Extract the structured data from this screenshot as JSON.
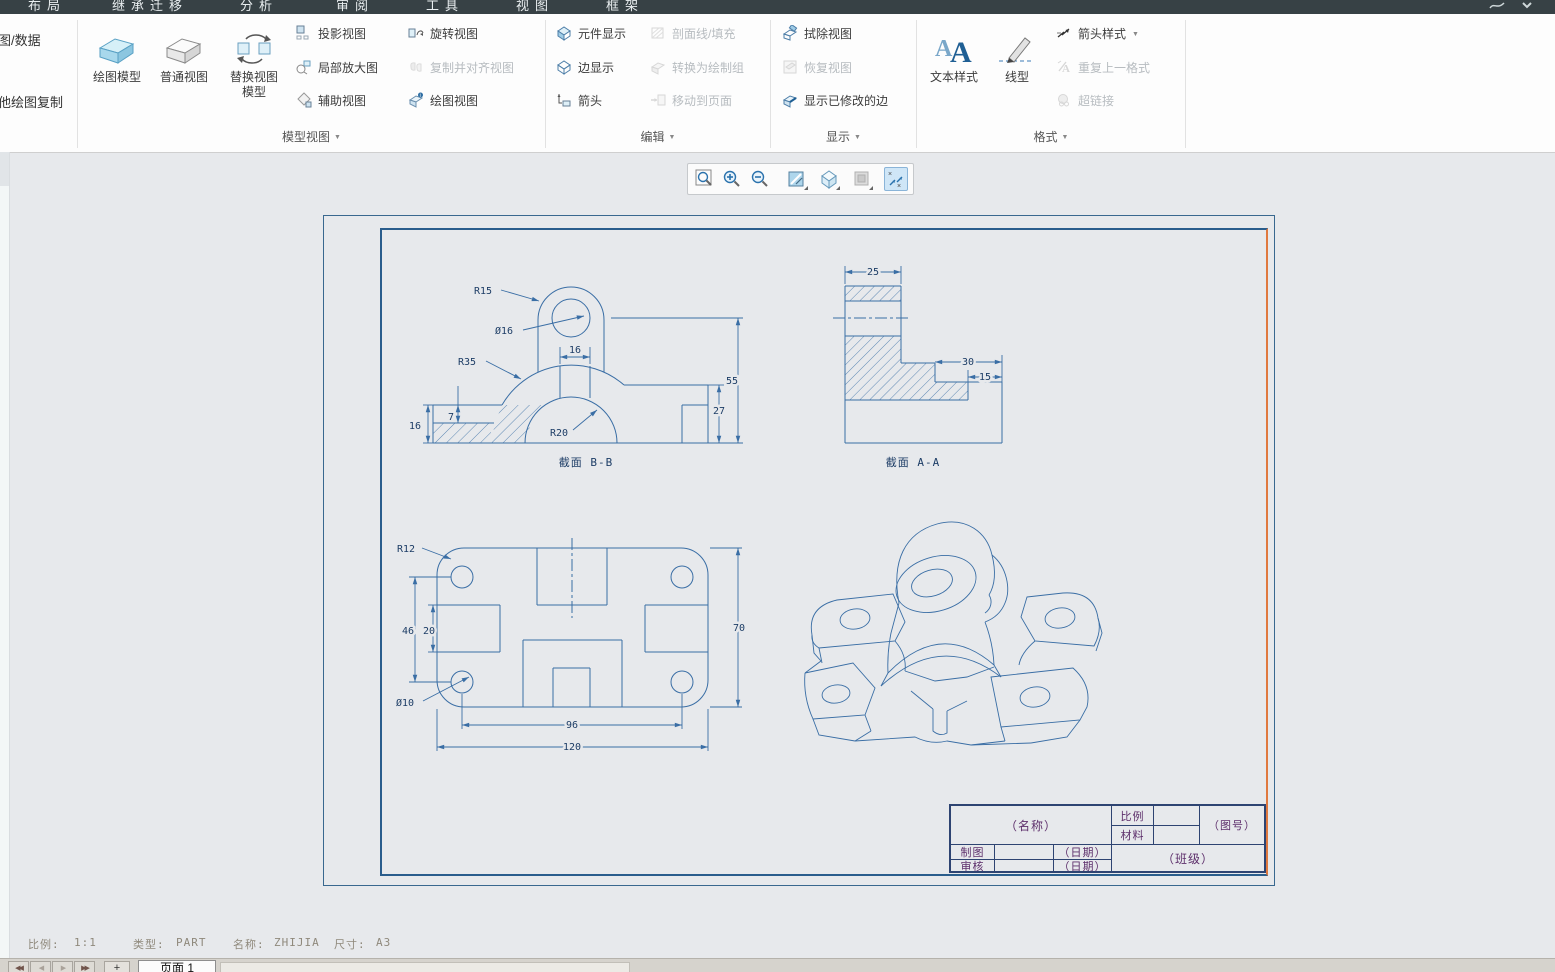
{
  "icons": {
    "dropdown": "▼",
    "nav_first": "◀◀",
    "nav_prev": "◀",
    "nav_next": "▶",
    "nav_last": "▶▶",
    "add_sheet": "+"
  },
  "tabs": {
    "layout": "布局",
    "legacy": "继承迁移",
    "analysis": "分析",
    "review": "审阅",
    "tools": "工具",
    "view": "视图",
    "framework": "框架"
  },
  "ribbon": {
    "left_panel": {
      "import_data": "图/数据",
      "copy_other": "他绘图复制"
    },
    "model_views": {
      "label": "模型视图",
      "draw_model": "绘图模型",
      "general_view": "普通视图",
      "replace_view_l1": "替换视图",
      "replace_view_l2": "模型",
      "projection": "投影视图",
      "detail": "局部放大图",
      "auxiliary": "辅助视图",
      "rotate": "旋转视图",
      "copy_align": "复制并对齐视图",
      "drawing_view": "绘图视图"
    },
    "edit": {
      "label": "编辑",
      "component_display": "元件显示",
      "edge_display": "边显示",
      "arrows": "箭头",
      "hatch_fill": "剖面线/填充",
      "convert_draft": "转换为绘制组",
      "move_to_sheet": "移动到页面"
    },
    "display": {
      "label": "显示",
      "erase_view": "拭除视图",
      "resume_view": "恢复视图",
      "show_modified_edges": "显示已修改的边"
    },
    "format": {
      "label": "格式",
      "text_style": "文本样式",
      "line_style": "线型",
      "arrow_style": "箭头样式",
      "repeat_last": "重复上一格式",
      "hyperlink": "超链接"
    }
  },
  "canvas": {
    "views": {
      "section_bb": {
        "caption": "截面  B-B",
        "dim_r15": "R15",
        "dim_d16": "Ø16",
        "dim_r35": "R35",
        "dim_16_top": "16",
        "dim_7": "7",
        "dim_16_left": "16",
        "dim_r20": "R20",
        "dim_55": "55",
        "dim_27": "27"
      },
      "section_aa": {
        "caption": "截面  A-A",
        "dim_25": "25",
        "dim_30": "30",
        "dim_15": "15"
      },
      "top_view": {
        "dim_r12": "R12",
        "dim_46": "46",
        "dim_20": "20",
        "dim_d10": "Ø10",
        "dim_96": "96",
        "dim_120": "120",
        "dim_70": "70"
      }
    },
    "title_block": {
      "name": "（名称）",
      "scale": "比例",
      "material": "材料",
      "drawing_no": "（图号）",
      "drafter": "制图",
      "checker": "审核",
      "date_1": "（日期）",
      "date_2": "（日期）",
      "class_name": "（班级）"
    }
  },
  "status_bar": {
    "scale_label": "比例:",
    "scale_value": "1:1",
    "type_label": "类型:",
    "type_value": "PART",
    "name_label": "名称:",
    "name_value": "ZHIJIA",
    "size_label": "尺寸:",
    "size_value": "A3"
  },
  "bottom_bar": {
    "page_tab": "页面 1"
  }
}
